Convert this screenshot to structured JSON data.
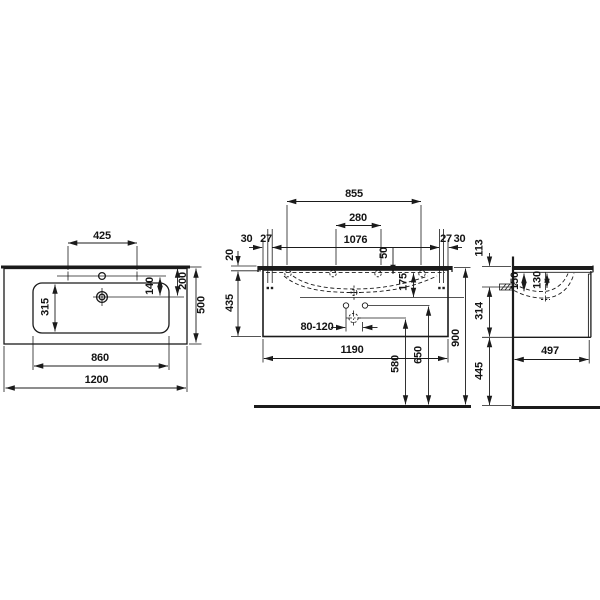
{
  "drawing": {
    "plan_view": {
      "dims": {
        "tap_hole_spacing": "425",
        "basin_inner_depth": "315",
        "tap_to_drain": "140",
        "back_edge_to_drain": "200",
        "basin_inner_width": "860",
        "overall_width": "1200",
        "overall_depth": "500"
      }
    },
    "front_view": {
      "dims": {
        "tap_holes_outer_spacing": "855",
        "tap_holes_inner_spacing": "280",
        "fixing_holes_spacing": "1076",
        "side_to_fixing_left": "30",
        "fixing_gap_left": "27",
        "fixing_gap_right": "27",
        "side_to_fixing_right": "30",
        "washbasin_thickness": "20",
        "rim_depth": "50",
        "bowl_depth": "175",
        "cabinet_height": "435",
        "drain_offset_range": "80-120",
        "cabinet_width": "1190",
        "drain_outlet_height": "580",
        "supply_height": "650",
        "overall_height": "900"
      }
    },
    "side_view": {
      "dims": {
        "top_to_outlet": "113",
        "bowl_depth_rear": "150",
        "bowl_depth_front": "130",
        "outlet_to_cabinet_bottom": "314",
        "cabinet_depth": "497",
        "cabinet_bottom_to_floor": "445"
      }
    }
  }
}
